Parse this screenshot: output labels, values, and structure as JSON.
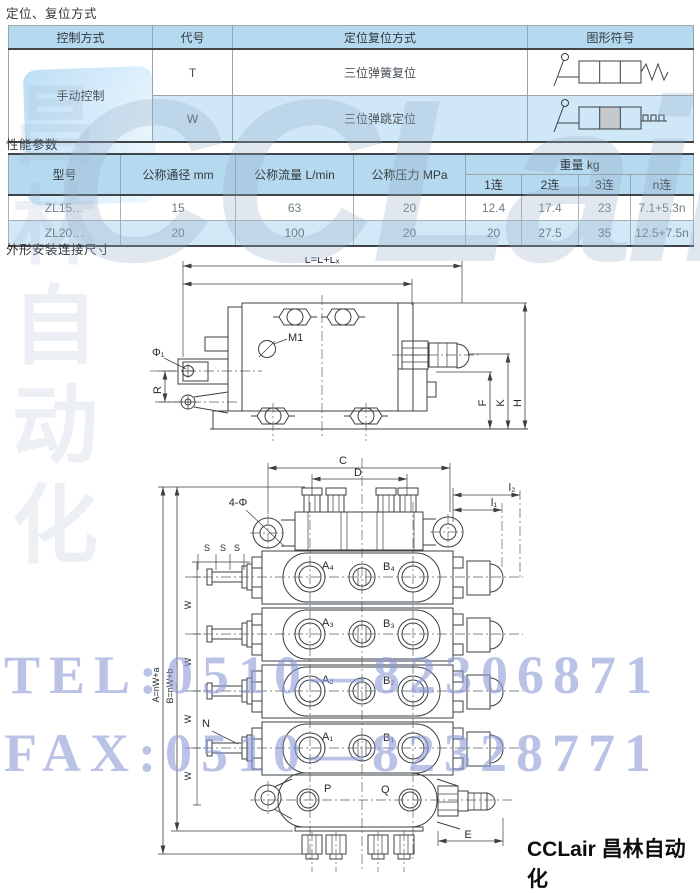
{
  "titles": {
    "s1": "定位、复位方式",
    "s2": "性能参数",
    "s3": "外形安装连接尺寸"
  },
  "control_table": {
    "headers": [
      "控制方式",
      "代号",
      "定位复位方式",
      "图形符号"
    ],
    "control_method": "手动控制",
    "rows": [
      {
        "code": "T",
        "method": "三位弹簧复位",
        "symbol": "spring-return-symbol"
      },
      {
        "code": "W",
        "method": "三位弹跳定位",
        "symbol": "detent-symbol"
      }
    ]
  },
  "performance_table": {
    "headers": [
      "型号",
      "公称通径 mm",
      "公称流量 L/min",
      "公称压力 MPa",
      "重量 kg"
    ],
    "weight_cols": [
      "1连",
      "2连",
      "3连",
      "n连"
    ],
    "rows": [
      [
        "ZL15…",
        "15",
        "63",
        "20",
        "12.4",
        "17.4",
        "23",
        "7.1+5.3n"
      ],
      [
        "ZL20…",
        "20",
        "100",
        "20",
        "20",
        "27.5",
        "35",
        "12.5+7.5n"
      ]
    ]
  },
  "drawing1": {
    "labels": {
      "dim_l": "L=L+Lₓ",
      "m1": "M1",
      "phi": "Φ₁",
      "r": "R",
      "f": "F",
      "k": "K",
      "h": "H"
    }
  },
  "drawing2": {
    "labels": {
      "c": "C",
      "d": "D",
      "four_phi": "4-Φ",
      "l2": "l₂",
      "l1": "l₁",
      "s": "S",
      "w": "W",
      "n": "N",
      "a_total": "A=nW+a",
      "b_total": "B=nW+b",
      "e": "E",
      "p": "P",
      "q": "Q"
    },
    "ports": {
      "a4": "A₄",
      "b4": "B₄",
      "a3": "A₃",
      "b3": "B₃",
      "a2": "A₂",
      "b2": "B₂",
      "a1": "A₁",
      "b1": "B₁"
    }
  },
  "watermarks": {
    "logo": "CCLair",
    "vertical_cn": "昌林自动化",
    "tel": "TEL:0510—82306871",
    "fax": "FAX:0510—82328771"
  },
  "footer": {
    "brand": "CCLair 昌林自动化"
  }
}
